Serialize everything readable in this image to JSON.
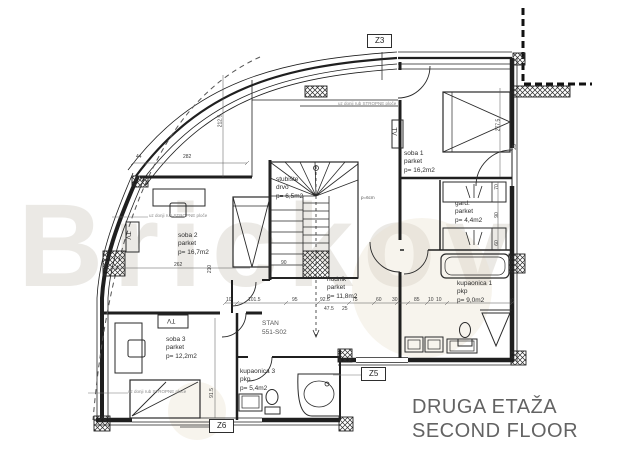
{
  "title": {
    "line1": "DRUGA ETAŽA",
    "line2": "SECOND FLOOR"
  },
  "watermark": "Brickov",
  "unit_label": {
    "line1": "STAN",
    "line2": "551-S02"
  },
  "markers": {
    "z3": "Z3",
    "z5": "Z5",
    "z6": "Z6"
  },
  "rooms": {
    "soba1": {
      "name": "soba 1",
      "floor": "parket",
      "area": "p= 16,2m2"
    },
    "soba2": {
      "name": "soba 2",
      "floor": "parket",
      "area": "p= 16,7m2"
    },
    "soba3": {
      "name": "soba 3",
      "floor": "parket",
      "area": "p= 12,2m2"
    },
    "gard": {
      "name": "gard.",
      "floor": "parket",
      "area": "p= 4,4m2"
    },
    "kupaonica1": {
      "name": "kupaonica 1",
      "floor": "pkp",
      "area": "p= 9,0m2"
    },
    "kupaonica3": {
      "name": "kupaonica 3",
      "floor": "pkp",
      "area": "p= 5,4m2"
    },
    "hodnik": {
      "name": "hodnik",
      "floor": "parket",
      "area": "p= 11,8m2"
    },
    "stubiste": {
      "name": "stubište",
      "floor": "drvo",
      "area": "p= 6,5m2"
    }
  },
  "notes": {
    "tv": "TV",
    "stair_thickness": "p=6cm",
    "slab_edge": "uz donji rub STROPNE ploče"
  },
  "dims": [
    "44",
    "282",
    "212.5",
    "262",
    "210",
    "277.5",
    "25",
    "10",
    "101.5",
    "95",
    "92.5",
    "75",
    "47.5",
    "25",
    "60",
    "30",
    "85",
    "10",
    "10",
    "25",
    "90",
    "91.5",
    "70",
    "60",
    "90"
  ]
}
